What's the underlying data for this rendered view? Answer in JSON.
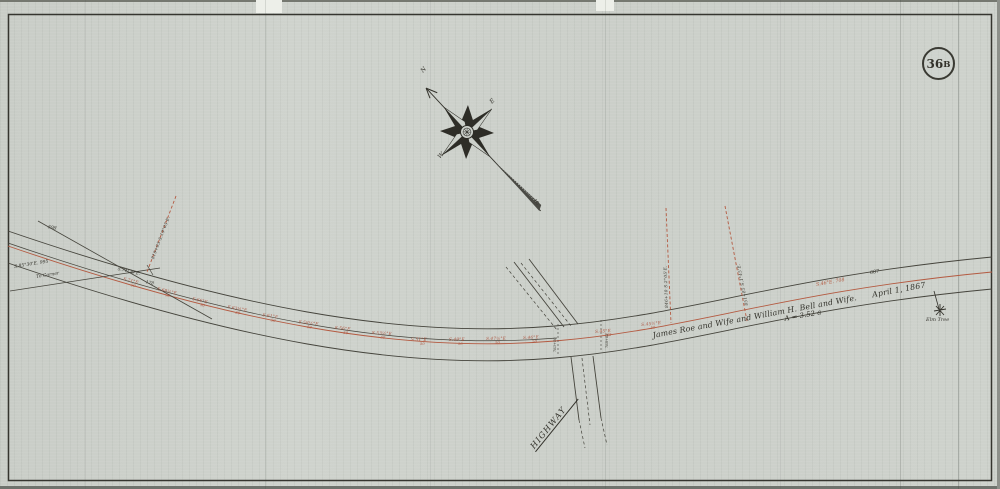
{
  "colors": {
    "paper": "#cdd1cb",
    "ink": "#33322b",
    "red": "#b45a41"
  },
  "badge": {
    "number": "36",
    "suffix": "B"
  },
  "compass": {
    "north": "N",
    "east": "E",
    "south": "S",
    "west": "W"
  },
  "deed": {
    "owners": "James Roe and Wife and William H. Bell and Wife.",
    "date": "April 1, 1867",
    "area": "A = 3.52 a"
  },
  "labels": {
    "highway": "HIGHWAY",
    "elm_tree": "Elm Tree",
    "tie_bearing": "S.85°30'E.   995",
    "tie_to": "To Corner",
    "left_chain": "598",
    "left_bearing": "S.74°39'E.",
    "left_distance": "178",
    "right_bearing": "S.46°E.   708",
    "right_distance": "687"
  },
  "offsets": [
    "819+05   S.19°05'E.",
    "846+10   S.2°05'E.",
    "851+85   S.1°45'E."
  ],
  "crossing_ticks": [
    "763+50",
    "768+02"
  ],
  "stations": [
    {
      "bearing": "S.71°E",
      "distance": "50"
    },
    {
      "bearing": "S.68½°E",
      "distance": "50"
    },
    {
      "bearing": "S.66°E",
      "distance": "50"
    },
    {
      "bearing": "S.63½°E",
      "distance": "50"
    },
    {
      "bearing": "S.61°E",
      "distance": "50"
    },
    {
      "bearing": "S.58½°E",
      "distance": "50"
    },
    {
      "bearing": "S.56°E",
      "distance": "50"
    },
    {
      "bearing": "S.53½°E",
      "distance": "50"
    },
    {
      "bearing": "S.51°E",
      "distance": "50"
    },
    {
      "bearing": "S.49°E",
      "distance": "50"
    },
    {
      "bearing": "S.47½°E",
      "distance": "50"
    },
    {
      "bearing": "S.46°E",
      "distance": "50"
    },
    {
      "bearing": "S.45°E",
      "distance": "762"
    },
    {
      "bearing": "S.45½°E",
      "distance": "50"
    }
  ]
}
